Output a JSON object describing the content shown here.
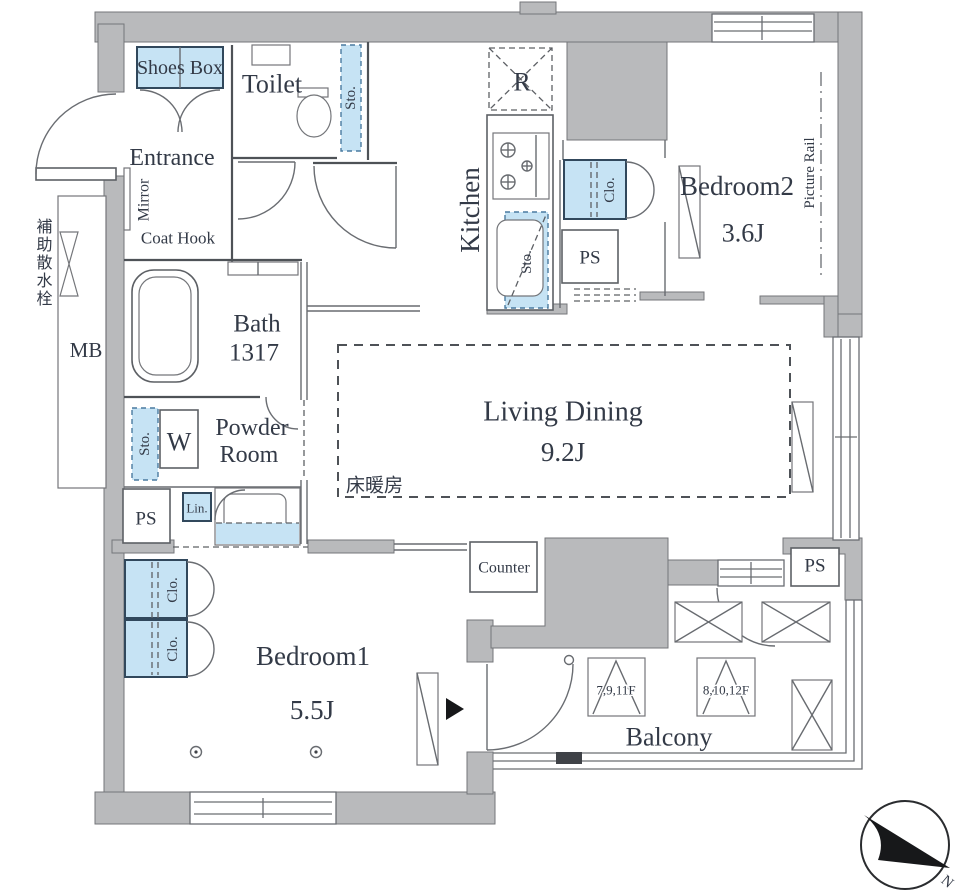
{
  "meta": {
    "type": "apartment-floor-plan"
  },
  "colors": {
    "wall": "#b9babc",
    "fixture-blue": "#c6e3f4",
    "line": "#4e5257",
    "text": "#333a47"
  },
  "labels": {
    "shoes_box": "Shoes Box",
    "toilet": "Toilet",
    "toilet_sto": "Sto.",
    "entrance": "Entrance",
    "mirror": "Mirror",
    "coat_hook": "Coat Hook",
    "fridge": "R",
    "kitchen": "Kitchen",
    "kitchen_sto": "Sto.",
    "kitchen_clo": "Clo.",
    "ps_kitchen": "PS",
    "bedroom2": "Bedroom2",
    "bedroom2_size": "3.6J",
    "picture_rail": "Picture Rail",
    "sprinkler": "補助散水栓",
    "mb": "MB",
    "bath": "Bath",
    "bath_size": "1317",
    "powder_line1": "Powder",
    "powder_line2": "Room",
    "washer": "W",
    "powder_sto": "Sto.",
    "lin": "Lin.",
    "ps_left": "PS",
    "living": "Living Dining",
    "living_size": "9.2J",
    "floor_heating": "床暖房",
    "counter": "Counter",
    "ps_right": "PS",
    "bedroom1": "Bedroom1",
    "bedroom1_size": "5.5J",
    "clo1": "Clo.",
    "clo2": "Clo.",
    "balcony": "Balcony",
    "hatch_a": "7,9,11F",
    "hatch_b": "8,10,12F",
    "north": "N"
  }
}
